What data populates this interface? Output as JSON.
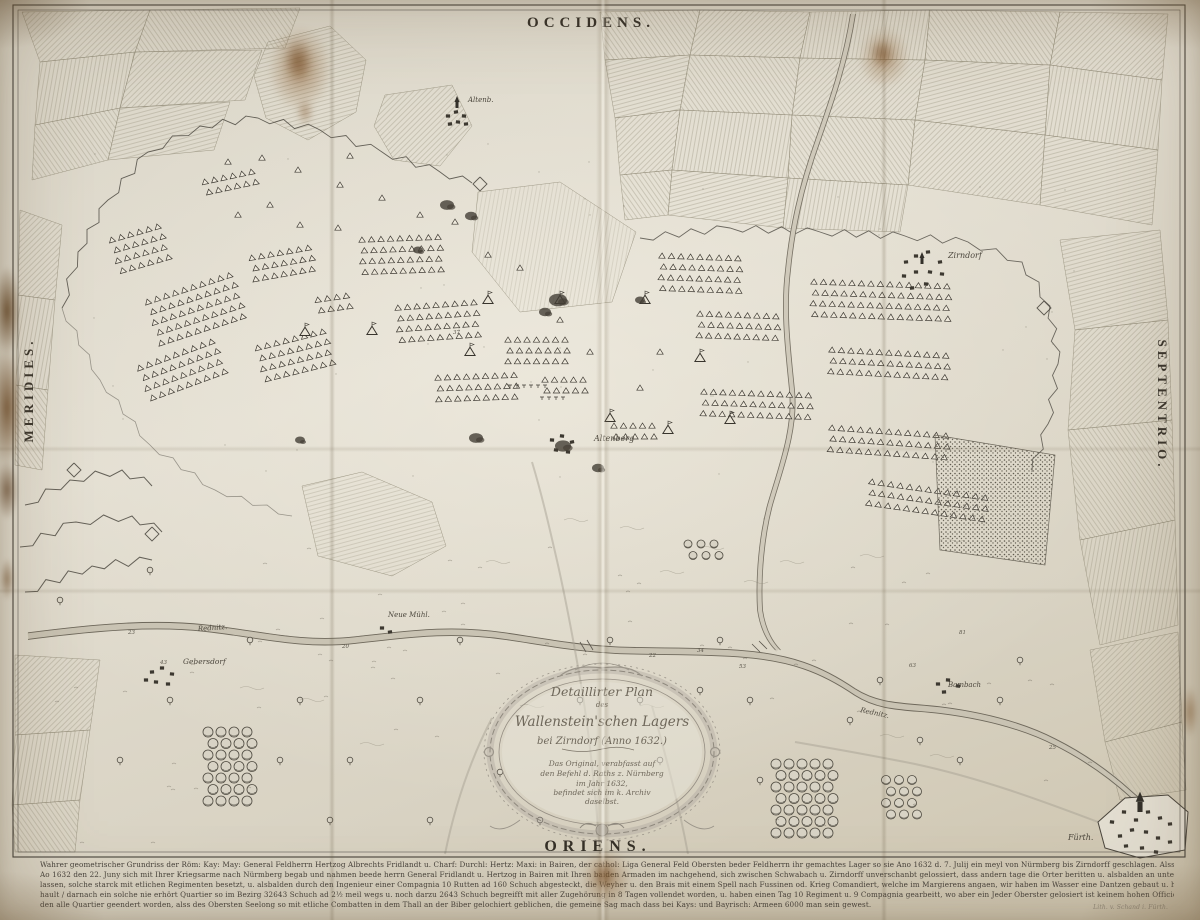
{
  "compass": {
    "west_top": "OCCIDENS.",
    "east_bottom": "ORIENS.",
    "south_left": "MERIDIES.",
    "north_right": "SEPTENTRIO."
  },
  "cartouche": {
    "lines": [
      "Detaillirter Plan",
      "des",
      "Wallenstein'schen Lagers",
      "bei Zirndorf (Anno 1632.)",
      "Das Original, verabfasst auf",
      "den Befehl d. Raths z. Nürnberg",
      "im Jahr 1632,",
      "befindet sich im k. Archiv",
      "daselbst."
    ]
  },
  "places": [
    {
      "text": "Altenb."
    },
    {
      "text": "Zirndorf"
    },
    {
      "text": "Altenberg"
    },
    {
      "text": "Neue Mühl."
    },
    {
      "text": "Rednitz."
    },
    {
      "text": "Gebersdorf"
    },
    {
      "text": "Bambach"
    },
    {
      "text": "Rednitz."
    },
    {
      "text": "Fürth."
    }
  ],
  "numbers": [
    {
      "t": "43"
    },
    {
      "t": "23"
    },
    {
      "t": "20"
    },
    {
      "t": "34"
    },
    {
      "t": "22"
    },
    {
      "t": "53"
    },
    {
      "t": "63"
    },
    {
      "t": "81"
    },
    {
      "t": "25"
    },
    {
      "t": "37"
    }
  ],
  "caption": {
    "lines": [
      "Wahrer geometrischer Grundriss der Röm: Kay: May: General Feldherrn Hertzog Albrechts Fridlandt u. Charf: Durchl: Hertz: Maxi: in Bairen, der cathol: Liga General Feld Obersten beder Feldherrn ihr gemachtes Lager so sie Ano 1632 d. 7. Julij ein meyl von Nürmberg bis Zirndorff geschlagen. Alss ihr König: May: zu Schweden",
      "Ao 1632 den 22. Juny sich mit Ihrer Kriegsarme nach Nürmberg begab und nahmen beede herrn General Fridlandt u. Hertzog in Bairen mit Ihren baiden Armaden im nachgehend, sich zwischen Schwabach u. Zirndorff unverschanbt gelossiert, dass andern tage die Orter beritten u. alsbalden an unterschidlichen Orten Redouten auffwerffen",
      "lassen, solche starck mit etlichen Regimenten besetzt, u. alsbalden durch den Ingenieur einer Compagnia 10 Rutten ad 160 Schuch abgesteckt, die Weyher u. den Brais mit einem Spell nach Fussinen od. Krieg Comandiert, welche im Margierens angaen, wir haben im Wasser eine Dantzen gebaut u. haben Schweden den Pass ver-",
      "hault / darnach ein solche nie erhört Quartier so im Bezirg 32643 Schuch ad 2½ meil wegs u. noch darzu 2643 Schuch begreifft mit aller Zugehörung in 8 Tagen vollendet worden, u. haben einen Tag 10 Regiment u. 9 Compagnia gearbeitt, wo aber ein Jeder Oberster gelosiert ist keinem hohen Officier bekant gewessen,",
      "den alle Quartier geendert worden, alss des Obersten Seelong so mit etliche Combatten in dem Thall an der Biber gelochiert geblichen, die gemeine Sag mach dass bei Kays: und Bayrisch: Armeen 6000 man sein gewest."
    ],
    "credit": "Lith. v. Schand i. Fürth."
  }
}
